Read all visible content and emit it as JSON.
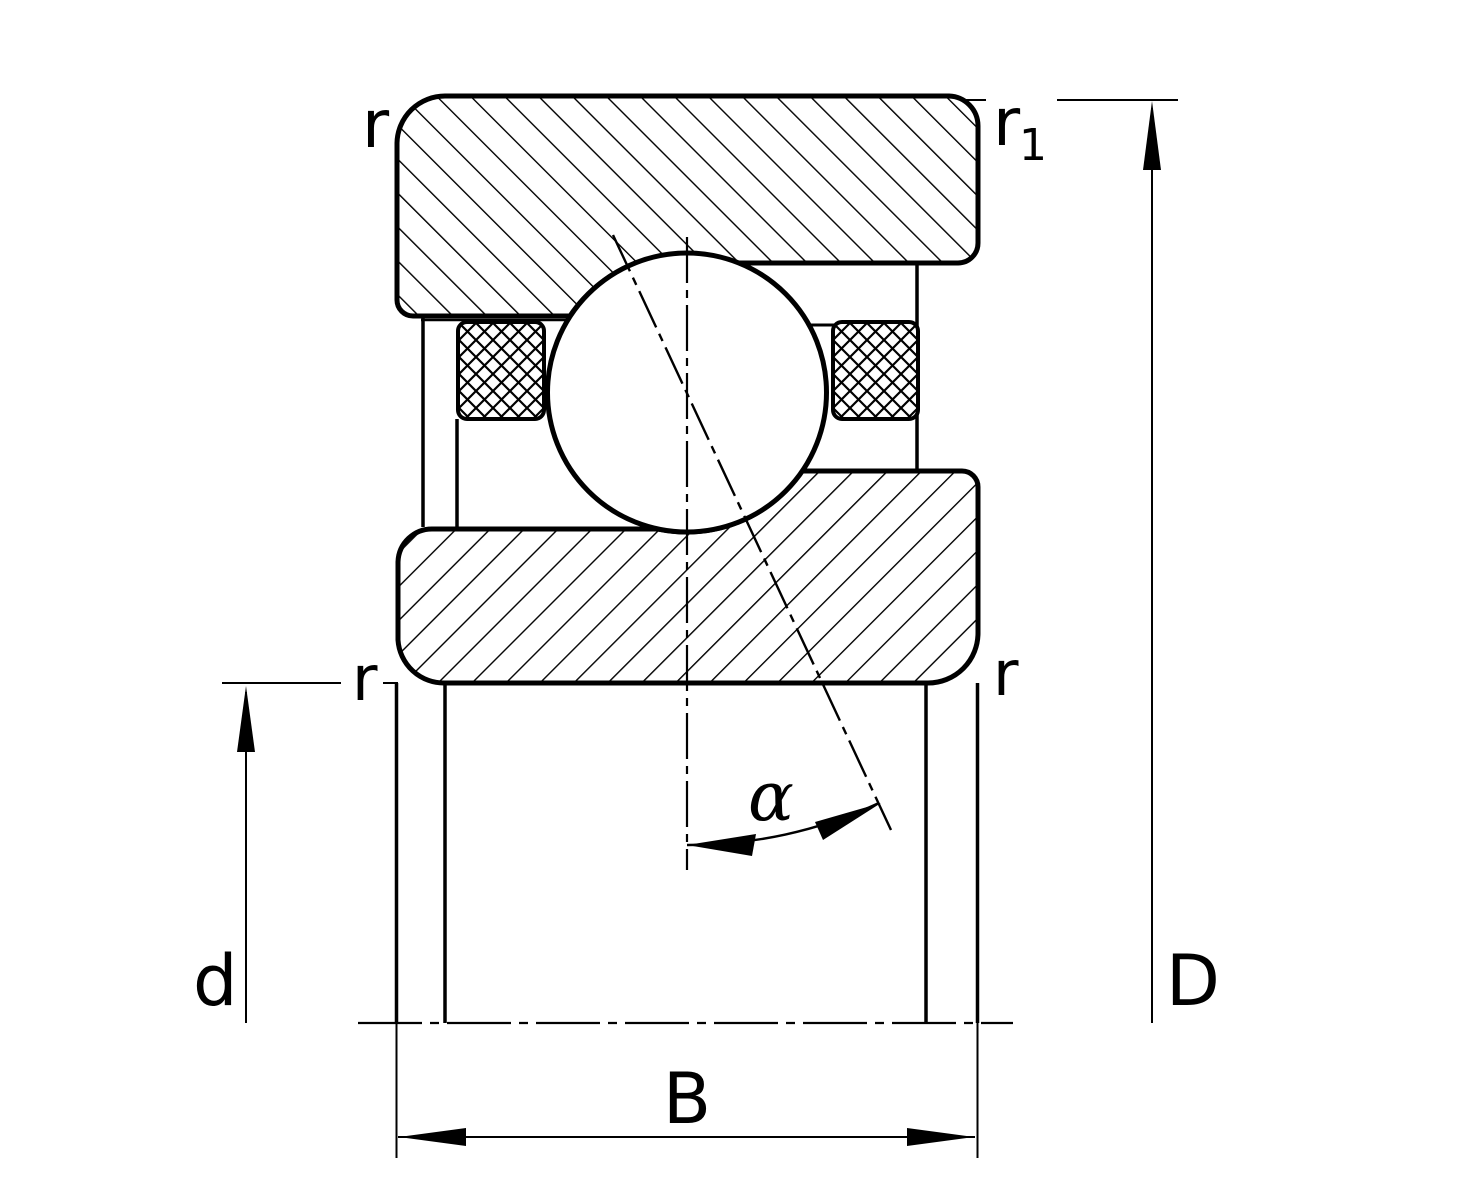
{
  "diagram": {
    "background": "#ffffff",
    "line_color": "#000000",
    "labels": {
      "chamfer_top_left": "r",
      "chamfer_top_right_base": "r",
      "chamfer_top_right_sub": "1",
      "chamfer_mid_left": "r",
      "chamfer_mid_right": "r",
      "bore_diameter": "d",
      "outside_diameter": "D",
      "width": "B",
      "contact_angle": "α"
    }
  }
}
